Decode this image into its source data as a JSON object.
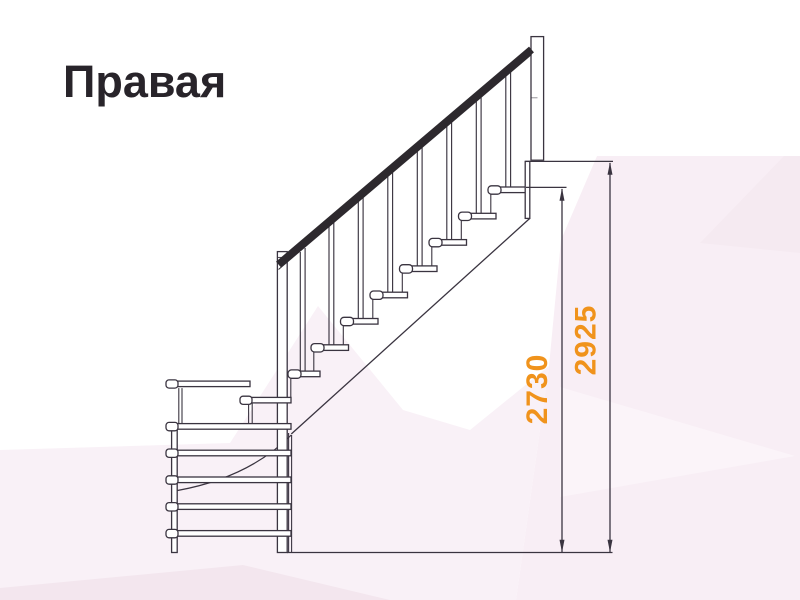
{
  "title": {
    "label": "Правая"
  },
  "diagram": {
    "kind": "staircase-side-view-technical-drawing",
    "subject": "Right-hand L-shaped staircase with lower winder steps, handrail, balusters and two height dimension lines",
    "straight_flight_treads": 8,
    "winder_boards": 6
  },
  "dimensions": {
    "items": [
      {
        "value": "2730",
        "extent": "floor line up to top tread surface"
      },
      {
        "value": "2925",
        "extent": "floor line up to upper landing surface"
      }
    ]
  },
  "colors": {
    "line": "#3a3440",
    "handrail": "#2d292e",
    "dimension_text": "#f0931c",
    "title_text": "#28242a",
    "background_base": "#ffffff",
    "background_facets": [
      "#f8eef5",
      "#f9f1f7",
      "#fbf4f9",
      "#f5eaf1",
      "#f3e6ee"
    ]
  }
}
